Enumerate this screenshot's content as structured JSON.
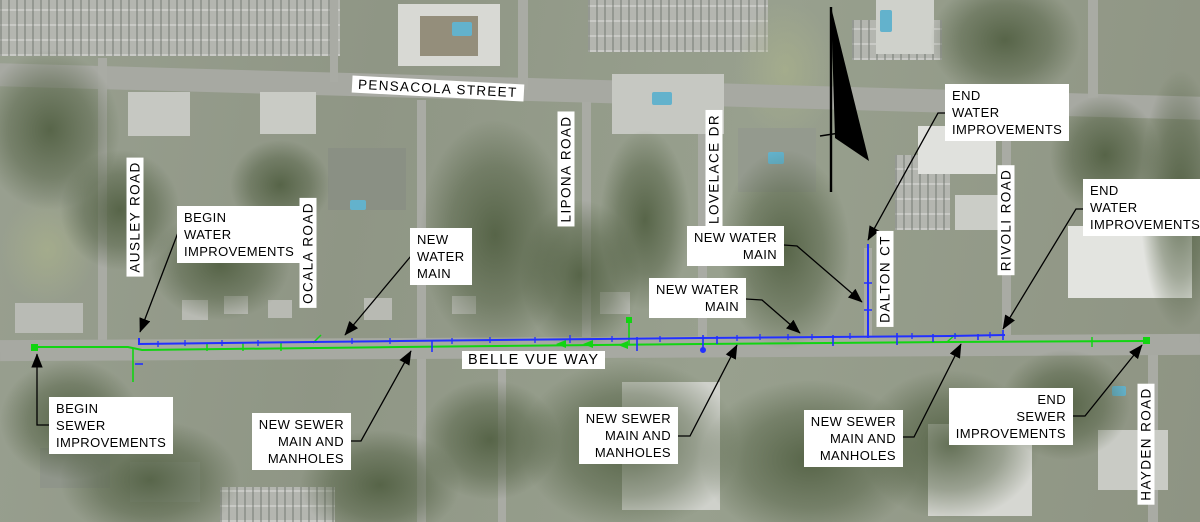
{
  "map": {
    "title": "utility improvements aerial plan",
    "streets": {
      "pensacola": "PENSACOLA STREET",
      "belle_vue": "BELLE VUE WAY",
      "ausley": "AUSLEY ROAD",
      "ocala": "OCALA ROAD",
      "lipona": "LIPONA ROAD",
      "lovelace": "LOVELACE DR",
      "dalton": "DALTON CT",
      "rivoli": "RIVOLI ROAD",
      "hayden": "HAYDEN ROAD"
    },
    "callouts": {
      "begin_water": {
        "lines": [
          "BEGIN",
          "WATER",
          "IMPROVEMENTS"
        ]
      },
      "new_water_main_west": {
        "lines": [
          "NEW",
          "WATER",
          "MAIN"
        ]
      },
      "new_water_main_dalton": {
        "lines": [
          "NEW WATER",
          "MAIN"
        ]
      },
      "new_water_main_belle_vue": {
        "lines": [
          "NEW WATER",
          "MAIN"
        ]
      },
      "end_water_dalton": {
        "lines": [
          "END",
          "WATER",
          "IMPROVEMENTS"
        ]
      },
      "end_water_east": {
        "lines": [
          "END",
          "WATER",
          "IMPROVEMENTS"
        ]
      },
      "begin_sewer": {
        "lines": [
          "BEGIN",
          "SEWER",
          "IMPROVEMENTS"
        ]
      },
      "new_sewer_west": {
        "lines": [
          "NEW SEWER",
          "MAIN AND",
          "MANHOLES"
        ]
      },
      "new_sewer_mid": {
        "lines": [
          "NEW SEWER",
          "MAIN AND",
          "MANHOLES"
        ]
      },
      "new_sewer_east": {
        "lines": [
          "NEW SEWER",
          "MAIN AND",
          "MANHOLES"
        ]
      },
      "end_sewer": {
        "lines": [
          "END",
          "SEWER",
          "IMPROVEMENTS"
        ]
      }
    },
    "colors": {
      "water_main": "#2230ff",
      "sewer_main": "#12d412",
      "leader": "#000000",
      "north_arrow": "#000000",
      "callout_bg": "#ffffff",
      "callout_text": "#000000"
    }
  }
}
